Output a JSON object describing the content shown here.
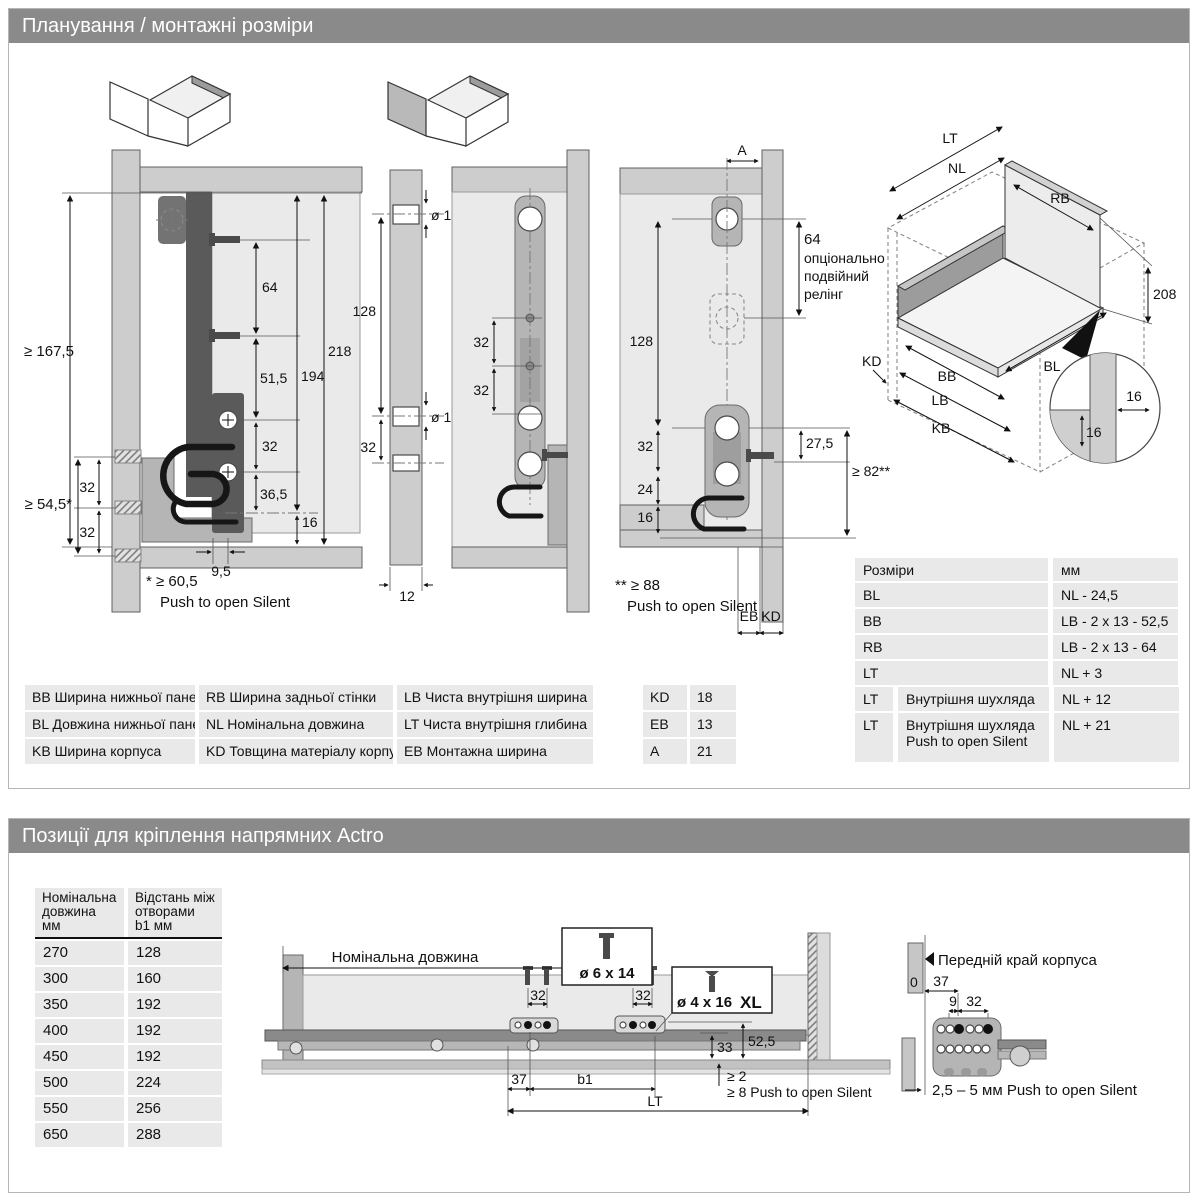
{
  "page": {
    "s1_title": "Планування / монтажні розміри",
    "s2_title": "Позиції для кріплення напрямних Actro"
  },
  "s1": {
    "d1": {
      "h_inner": "≥ 167,5",
      "v64": "64",
      "v51": "51,5",
      "v194": "194",
      "v218": "218",
      "v32": "32",
      "v36": "36,5",
      "v16": "16",
      "v95": "9,5",
      "l32a": "32",
      "l32b": "32",
      "l54": "≥ 54,5*",
      "fn1": "* ≥ 60,5",
      "fn2": "Push to open Silent"
    },
    "d2": {
      "dia1": "ø 10",
      "v128": "128",
      "dia2": "ø 10",
      "v32": "32",
      "w12": "12"
    },
    "d3": {
      "v32a": "32",
      "v32b": "32"
    },
    "d4": {
      "a": "A",
      "v64": "64",
      "opt1": "опціонально",
      "opt2": "подвійний",
      "opt3": "релінг",
      "v128": "128",
      "v32": "32",
      "v24": "24",
      "v16": "16",
      "v27": "27,5",
      "v82": "≥ 82**",
      "eb": "EB",
      "kd": "KD",
      "fn1": "** ≥ 88",
      "fn2": "Push to open Silent"
    },
    "iso": {
      "lt": "LT",
      "nl": "NL",
      "rb": "RB",
      "v208": "208",
      "kd": "KD",
      "bb": "BB",
      "lb": "LB",
      "kb": "KB",
      "bl": "BL",
      "v16a": "16",
      "v16b": "16"
    },
    "legend": [
      [
        "BB Ширина нижньої панелі",
        "RB Ширина задньої стінки",
        "LB Чиста внутрішня ширина"
      ],
      [
        "BL Довжина нижньої панелі",
        "NL Номінальна довжина",
        "LT Чиста внутрішня глибина"
      ],
      [
        "KB Ширина корпуса",
        "KD Товщина матеріалу корпуса",
        "EB Монтажна ширина"
      ]
    ],
    "abbr": [
      [
        "KD",
        "18"
      ],
      [
        "EB",
        "13"
      ],
      [
        "A",
        "21"
      ]
    ],
    "dims": {
      "h1": "Розміри",
      "h2": "мм",
      "rows": [
        [
          "BL",
          "NL - 24,5"
        ],
        [
          "BB",
          "LB - 2 x 13 - 52,5"
        ],
        [
          "RB",
          "LB - 2 x 13 - 64"
        ],
        [
          "LT",
          "NL + 3"
        ]
      ],
      "rows2": [
        {
          "c": "LT",
          "l1": "Внутрішня шухляда",
          "v": "NL + 12"
        },
        {
          "c": "LT",
          "l1": "Внутрішня шухляда",
          "l2": "Push to open Silent",
          "v": "NL + 21"
        }
      ]
    }
  },
  "s2": {
    "table": {
      "h1": [
        "Номінальна",
        "довжина",
        "мм"
      ],
      "h2": [
        "Відстань між",
        "отворами",
        "b1 мм"
      ],
      "rows": [
        [
          "270",
          "128"
        ],
        [
          "300",
          "160"
        ],
        [
          "350",
          "192"
        ],
        [
          "400",
          "192"
        ],
        [
          "450",
          "192"
        ],
        [
          "500",
          "224"
        ],
        [
          "550",
          "256"
        ],
        [
          "650",
          "288"
        ]
      ]
    },
    "dwg": {
      "nominal": "Номінальна довжина",
      "box1": "ø 6 x 14",
      "box2": "ø 4 x 16",
      "xl": "XL",
      "v32a": "32",
      "v32b": "32",
      "v33": "33",
      "v52": "52,5",
      "v37": "37",
      "b1": "b1",
      "lt": "LT",
      "ge2": "≥ 2",
      "ge8": "≥ 8 Push to open Silent"
    },
    "right": {
      "edge": "Передній край корпуса",
      "zero": "0",
      "v37": "37",
      "v9": "9",
      "v32": "32",
      "note": "2,5 – 5 мм Push to open Silent"
    }
  }
}
